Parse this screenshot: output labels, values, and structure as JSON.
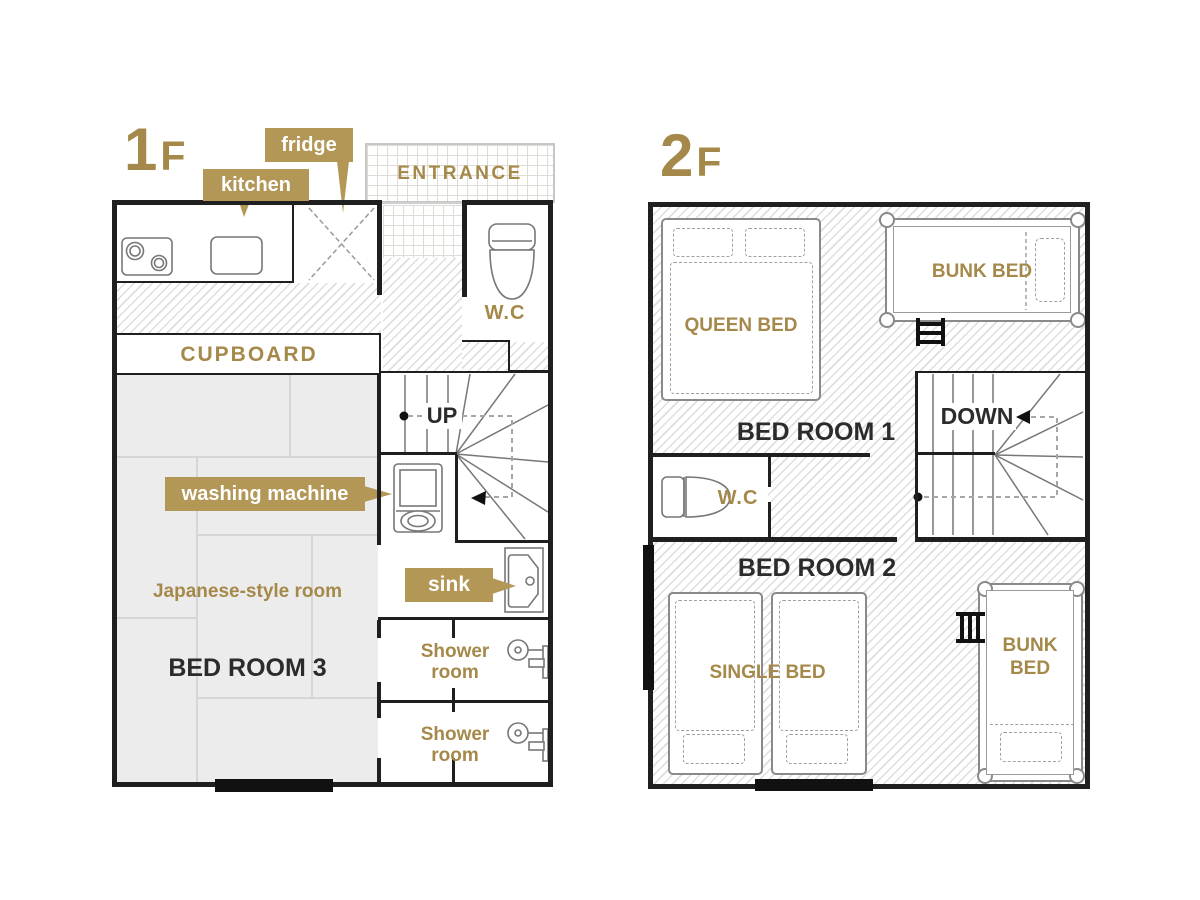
{
  "colors": {
    "gold_text": "#a5894a",
    "callout_bg": "#b29757",
    "wall": "#1f1f1f",
    "tatami_fill": "#ececec"
  },
  "floor1": {
    "title_number": "1",
    "title_letter": "F",
    "fridge_callout": "fridge",
    "kitchen_callout": "kitchen",
    "entrance_label": "ENTRANCE",
    "wc_label": "W.C",
    "cupboard_label": "CUPBOARD",
    "up_label": "UP",
    "washing_machine_callout": "washing machine",
    "japanese_room_label": "Japanese-style room",
    "bedroom3_label": "BED ROOM 3",
    "sink_callout": "sink",
    "shower_rooms": [
      {
        "line1": "Shower",
        "line2": "room"
      },
      {
        "line1": "Shower",
        "line2": "room"
      }
    ]
  },
  "floor2": {
    "title_number": "2",
    "title_letter": "F",
    "queen_bed_label": "QUEEN BED",
    "bunk_bed_top_label": "BUNK BED",
    "bedroom1_label": "BED ROOM 1",
    "down_label": "DOWN",
    "wc_label": "W.C",
    "bedroom2_label": "BED ROOM 2",
    "single_bed_label": "SINGLE BED",
    "bunk_bed_right_line1": "BUNK",
    "bunk_bed_right_line2": "BED"
  }
}
